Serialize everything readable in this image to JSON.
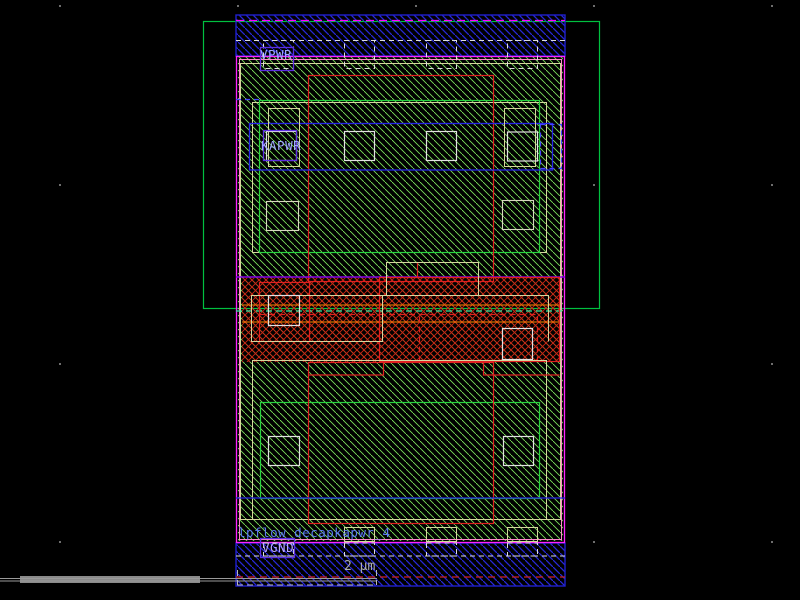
{
  "canvas": {
    "tool": "vlsi-layout-viewer",
    "cell_name": "lpflow_decapkapwr_4",
    "labels": {
      "vpwr": "VPWR",
      "kapwr": "KAPWR",
      "vgnd": "VGND"
    },
    "scale_label": "2 µm",
    "colors": {
      "background": "#000000",
      "nwell_outline": "#00c040",
      "rail_metal_blue": "#2727d8",
      "cell_border_magenta": "#ff22ff",
      "cell_border_pink": "#ff88cc",
      "poly_red": "#e02020",
      "diff_tan": "#d6d69e",
      "hatch_green": "#7ce05a",
      "well_edge_violet": "#8a00e6",
      "select_mint": "#2fe89e",
      "orange_line": "#ff8800",
      "pin_box_purple": "#5c2ee0",
      "label_text": "#9fa8ff",
      "cell_name_text": "#5b79f2",
      "scale_text": "#b0b0b0",
      "scrollbar_gray": "#8a8a8a"
    }
  }
}
